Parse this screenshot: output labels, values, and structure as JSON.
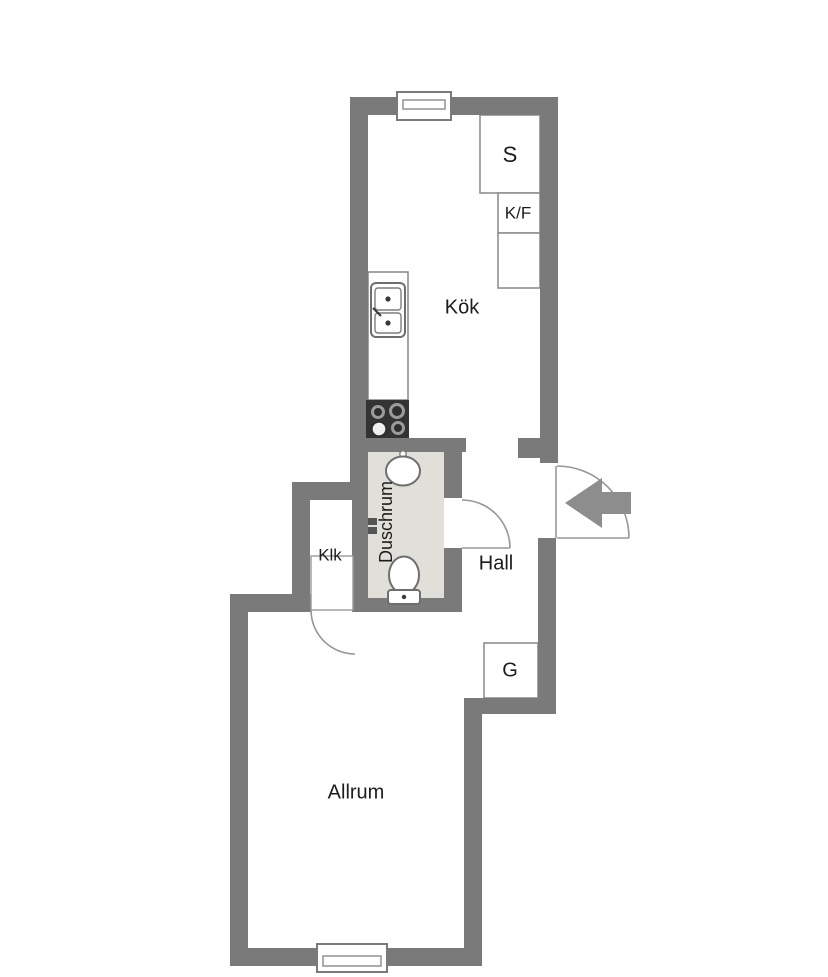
{
  "plan_title": "Apartment floor plan",
  "rooms": {
    "kok": {
      "label": "Kök"
    },
    "duschrum": {
      "label": "Duschrum"
    },
    "klk": {
      "label": "Klk"
    },
    "hall": {
      "label": "Hall"
    },
    "allrum": {
      "label": "Allrum"
    }
  },
  "storage": {
    "s": {
      "label": "S"
    },
    "kf": {
      "label": "K/F"
    },
    "g": {
      "label": "G"
    }
  },
  "fixtures": [
    "window-icon-top",
    "window-icon-bottom",
    "kitchen-sink-icon",
    "stove-icon",
    "washbasin-icon",
    "toilet-icon",
    "entry-arrow-icon",
    "door-swing-arc"
  ],
  "palette": {
    "wall": "#7a7a7a",
    "floor-bath": "#e1dfd9",
    "line": "#8f8f8f",
    "text": "#1c1c1c",
    "bg": "#ffffff",
    "stove": "#333333",
    "arrow": "#8d8d8d"
  }
}
